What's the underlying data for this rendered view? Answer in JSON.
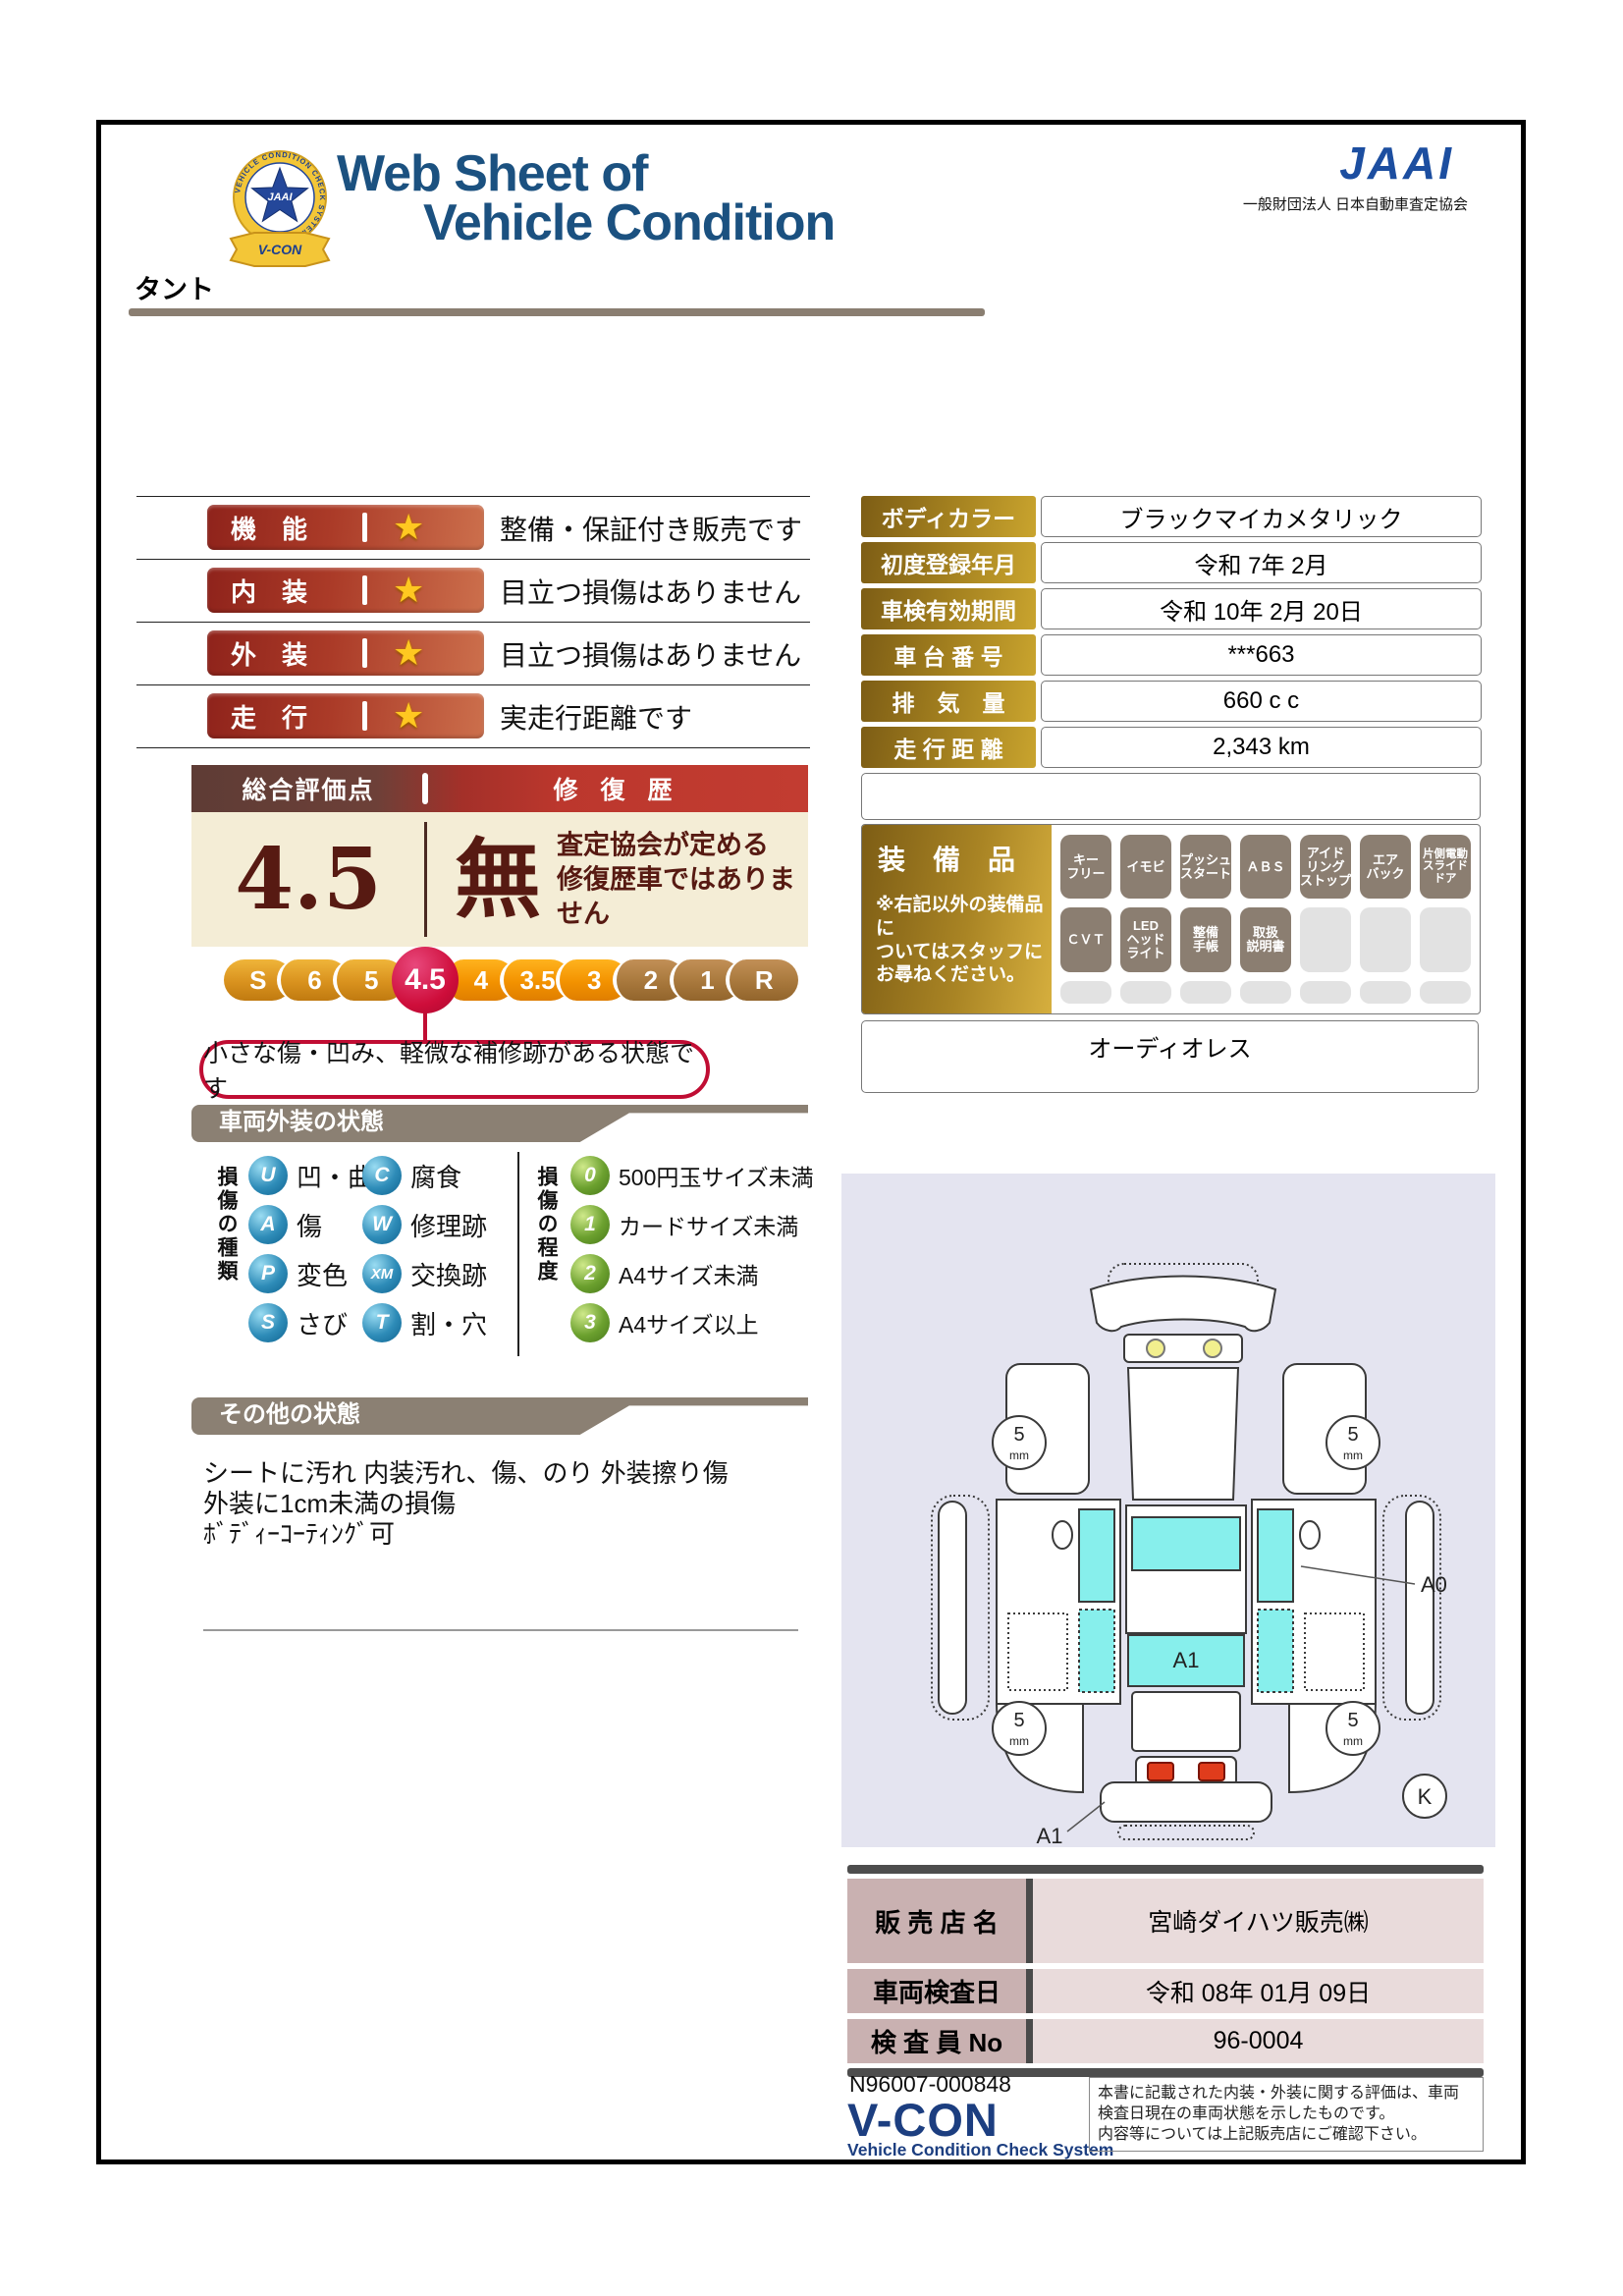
{
  "header": {
    "title_line1": "Web Sheet of",
    "title_line2": "Vehicle Condition",
    "jaai_word": "JAAI",
    "jaai_org": "一般財団法人 日本自動車査定協会",
    "badge_ring_text": "VEHICLE CONDITION CHECK SYSTEM",
    "badge_center": "JAAI",
    "badge_ribbon": "V-CON"
  },
  "vehicle_name": "タント",
  "icons": {
    "star": "★"
  },
  "ratings": [
    {
      "label": "機　能",
      "desc": "整備・保証付き販売です"
    },
    {
      "label": "内　装",
      "desc": "目立つ損傷はありません"
    },
    {
      "label": "外　装",
      "desc": "目立つ損傷はありません"
    },
    {
      "label": "走　行",
      "desc": "実走行距離です"
    }
  ],
  "overall": {
    "header_left": "総合評価点",
    "header_right": "修 復 歴",
    "score": "4.5",
    "repair": "無",
    "repair_note": "査定協会が定める\n修復歴車ではありません",
    "scale": [
      "S",
      "6",
      "5",
      "4.5",
      "4",
      "3.5",
      "3",
      "2",
      "1",
      "R"
    ],
    "bubble": "小さな傷・凹み、軽微な補修跡がある状態です"
  },
  "vehicle_info": {
    "rows": [
      {
        "label": "ボディカラー",
        "value": "ブラックマイカメタリック"
      },
      {
        "label": "初度登録年月",
        "value": "令和 7年 2月"
      },
      {
        "label": "車検有効期間",
        "value": "令和 10年 2月 20日"
      },
      {
        "label": "車 台 番 号",
        "value": "***663"
      },
      {
        "label": "排　気　量",
        "value": "660 c c"
      },
      {
        "label": "走 行 距 離",
        "value": "2,343 km"
      }
    ]
  },
  "equipment": {
    "title": "装　備　品",
    "note": "※右記以外の装備品に\nついてはスタッフに\nお尋ねください。",
    "badges": [
      "キー\nフリー",
      "イモビ",
      "プッシュ\nスタート",
      "ＡＢＳ",
      "アイド\nリング\nストップ",
      "エア\nバック",
      "片側電動\nスライド\nドア",
      "ＣＶＴ",
      "LED\nヘッド\nライト",
      "整備\n手帳",
      "取扱\n説明書"
    ],
    "extra": "オーディオレス"
  },
  "exterior": {
    "header": "車両外装の状態",
    "type_label": "損傷の種類",
    "types": [
      {
        "code": "U",
        "text": "凹・曲"
      },
      {
        "code": "C",
        "text": "腐食"
      },
      {
        "code": "A",
        "text": "傷"
      },
      {
        "code": "W",
        "text": "修理跡"
      },
      {
        "code": "P",
        "text": "変色"
      },
      {
        "code": "XM",
        "text": "交換跡"
      },
      {
        "code": "S",
        "text": "さび"
      },
      {
        "code": "T",
        "text": "割・穴"
      }
    ],
    "degree_label": "損傷の程度",
    "degrees": [
      {
        "code": "0",
        "text": "500円玉サイズ未満"
      },
      {
        "code": "1",
        "text": "カードサイズ未満"
      },
      {
        "code": "2",
        "text": "A4サイズ未満"
      },
      {
        "code": "3",
        "text": "A4サイズ以上"
      }
    ]
  },
  "other_condition": {
    "header": "その他の状態",
    "text": "シートに汚れ 内装汚れ、傷、のり 外装擦り傷\n外装に1cm未満の損傷\nﾎﾞﾃﾞｨｰｺｰﾃｨﾝｸﾞ可"
  },
  "diagram": {
    "tire_value": "5",
    "tire_unit": "mm",
    "label_a0": "A0",
    "label_a1_window": "A1",
    "label_a1_bumper": "A1",
    "label_k": "K"
  },
  "dealer": {
    "rows": [
      {
        "label": "販 売 店 名",
        "value": "宮崎ダイハツ販売㈱"
      },
      {
        "label": "車両検査日",
        "value": "令和 08年 01月 09日"
      },
      {
        "label": "検 査 員 No",
        "value": "96-0004"
      }
    ]
  },
  "footer": {
    "serial": "N96007-000848",
    "vcon": "V-CON",
    "vcon_sub": "Vehicle Condition Check System",
    "note": "本書に記載された内装・外装に関する評価は、車両\n検査日現在の車両状態を示したものです。\n内容等については上記販売店にご確認下さい。"
  }
}
